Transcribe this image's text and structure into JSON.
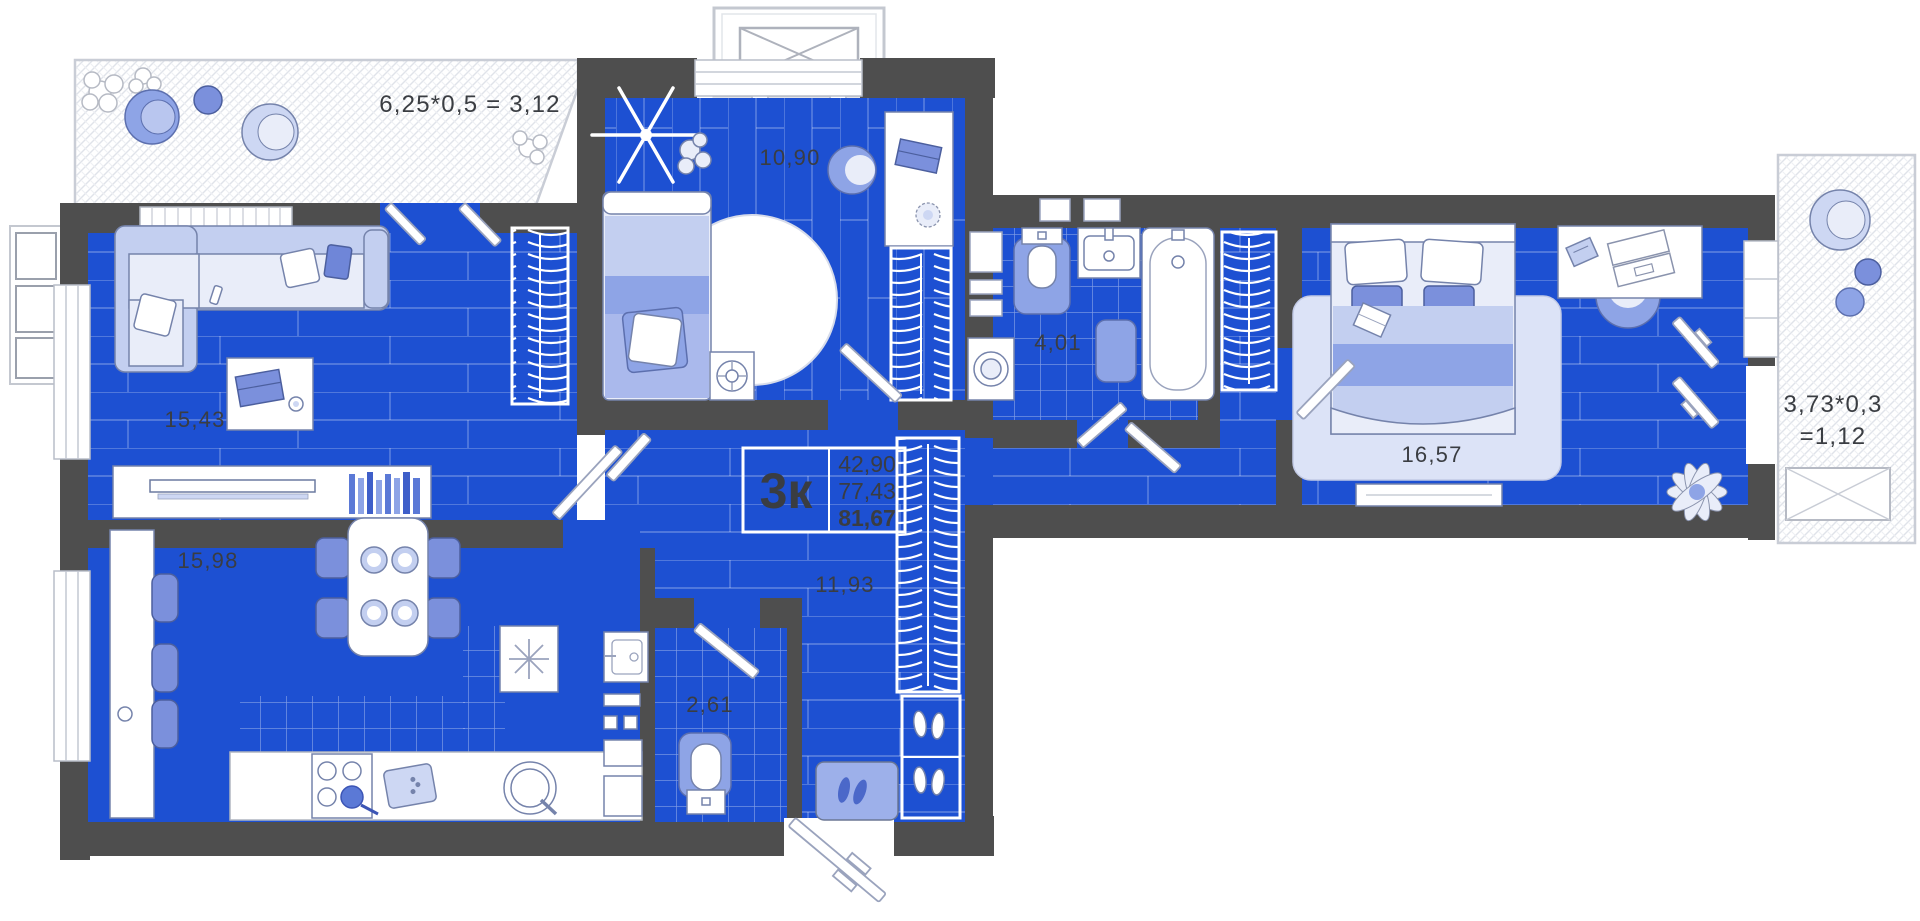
{
  "info_box": {
    "rooms_count": "3к",
    "area_living": "42,90",
    "area_usable": "77,43",
    "area_total": "81,67"
  },
  "rooms": {
    "living_room": "15,43",
    "bedroom_small": "10,90",
    "bathroom": "4,01",
    "bedroom_master": "16,57",
    "kitchen": "15,98",
    "hallway": "11,93",
    "wc": "2,61"
  },
  "balconies": {
    "left_formula": "6,25*0,5 = 3,12",
    "right_formula_line1": "3,73*0,3",
    "right_formula_line2": "=1,12"
  },
  "colors": {
    "floor_blue": "#1d50d2",
    "wall_gray": "#4e4e4e",
    "furniture_light": "#e9edf9",
    "furniture_periwinkle": "#8ea4e6",
    "furniture_accent": "#5b79d6",
    "label_text": "#3a3d42",
    "hatch_line": "#e0e3ea"
  }
}
